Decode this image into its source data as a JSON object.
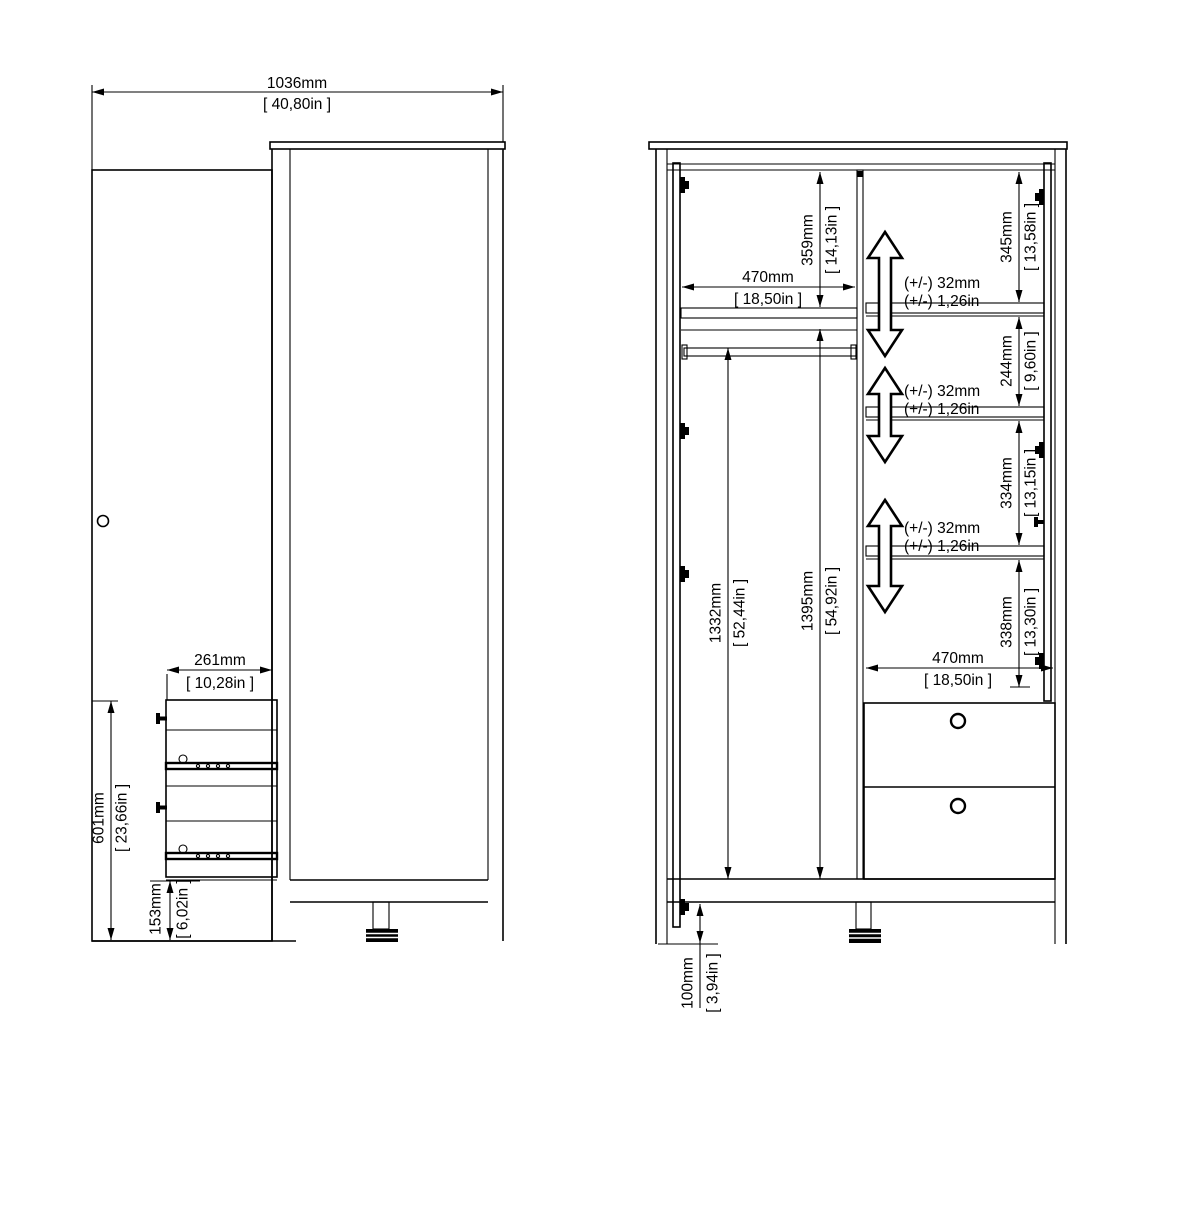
{
  "side_view": {
    "overall_width": {
      "mm": "1036mm",
      "in": "[ 40,80in ]"
    },
    "drawer_depth": {
      "mm": "261mm",
      "in": "[ 10,28in ]"
    },
    "drawer_unit_height": {
      "mm": "601mm",
      "in": "[ 23,66in ]"
    },
    "base_height": {
      "mm": "153mm",
      "in": "[ 6,02in ]"
    }
  },
  "front_view": {
    "left_compartment_width": {
      "mm": "470mm",
      "in": "[ 18,50in ]"
    },
    "top_section_height": {
      "mm": "359mm",
      "in": "[ 14,13in ]"
    },
    "hanging_height": {
      "mm": "1332mm",
      "in": "[ 52,44in ]"
    },
    "interior_height": {
      "mm": "1395mm",
      "in": "[ 54,92in ]"
    },
    "right_section_1": {
      "mm": "345mm",
      "in": "[ 13,58in ]"
    },
    "right_section_2": {
      "mm": "244mm",
      "in": "[ 9,60in ]"
    },
    "right_section_3": {
      "mm": "334mm",
      "in": "[ 13,15in ]"
    },
    "right_section_4": {
      "mm": "338mm",
      "in": "[ 13,30in ]"
    },
    "drawer_width": {
      "mm": "470mm",
      "in": "[ 18,50in ]"
    },
    "foot_height": {
      "mm": "100mm",
      "in": "[ 3,94in ]"
    },
    "shelf_adjustment": {
      "mm": "(+/-) 32mm",
      "in": "(+/-) 1,26in"
    }
  }
}
